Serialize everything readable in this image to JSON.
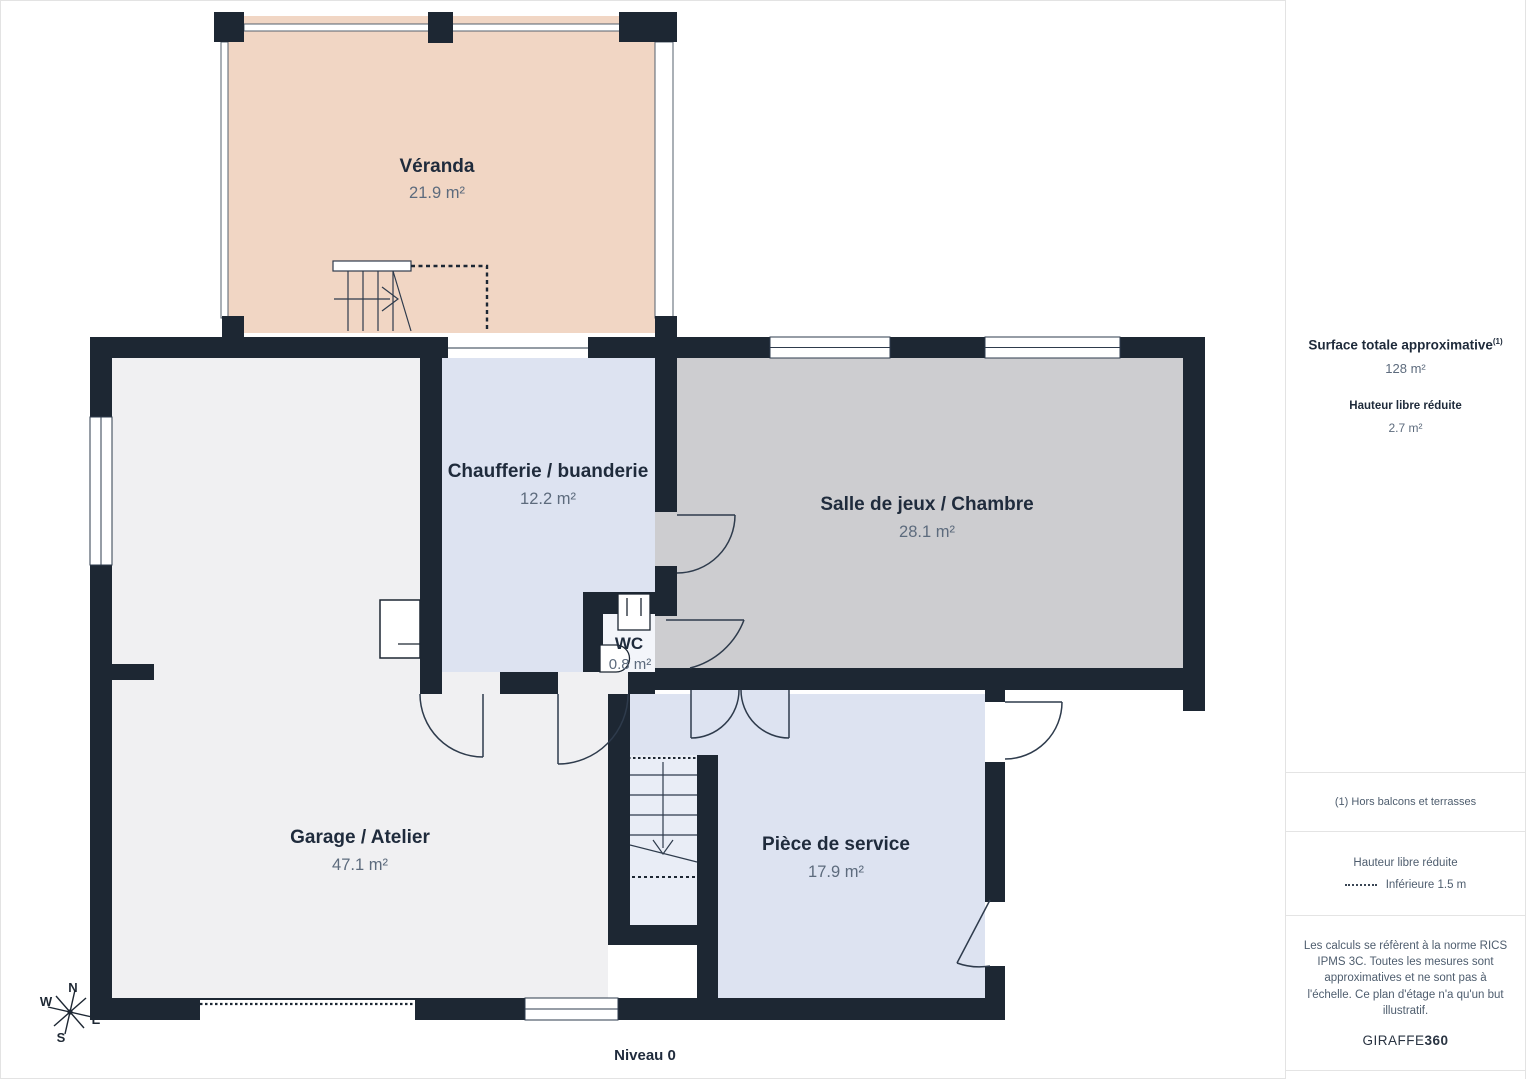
{
  "plan": {
    "level_label": "Niveau 0",
    "colors": {
      "wall": "#1d2733",
      "veranda": "#f1d6c4",
      "garage": "#f0f0f2",
      "chaufferie": "#dde3f1",
      "salle": "#cdcdd0",
      "wc": "#f3f5fa",
      "piece": "#dde3f1",
      "stairs_floor": "#e9edf6"
    },
    "rooms": [
      {
        "id": "veranda",
        "name": "Véranda",
        "area": "21.9 m²"
      },
      {
        "id": "garage",
        "name": "Garage / Atelier",
        "area": "47.1 m²"
      },
      {
        "id": "chaufferie",
        "name": "Chaufferie / buanderie",
        "area": "12.2 m²"
      },
      {
        "id": "salle_de_jeux",
        "name": "Salle de jeux / Chambre",
        "area": "28.1 m²"
      },
      {
        "id": "wc",
        "name": "WC",
        "area": "0.8 m²"
      },
      {
        "id": "piece_de_service",
        "name": "Pièce de service",
        "area": "17.9 m²"
      }
    ],
    "compass": {
      "north": "N",
      "west": "W",
      "south": "S",
      "east": "E"
    }
  },
  "sidebar": {
    "surface_title": "Surface totale approximative",
    "surface_footnote_marker": "(1)",
    "surface_value": "128 m²",
    "reduced_height_title": "Hauteur libre réduite",
    "reduced_height_value": "2.7 m²",
    "footnote": "(1) Hors balcons et terrasses",
    "legend_title": "Hauteur libre réduite",
    "legend_item": "Inférieure 1.5 m",
    "disclaimer": "Les calculs se réfèrent à la norme RICS IPMS 3C. Toutes les mesures sont approximatives et ne sont pas à l'échelle. Ce plan d'étage n'a qu'un but illustratif.",
    "brand_name": "GIRAFFE",
    "brand_suffix": "360"
  }
}
